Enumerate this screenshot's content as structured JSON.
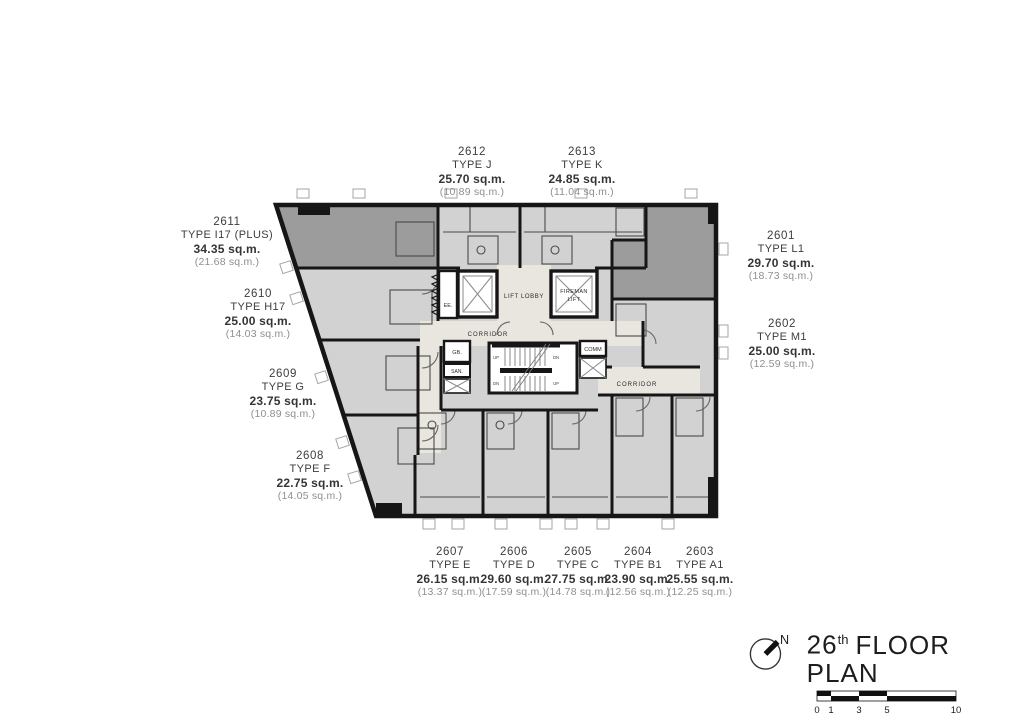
{
  "title": {
    "floor_number": "26",
    "ordinal_suffix": "th",
    "text": "FLOOR PLAN"
  },
  "north": {
    "label": "N"
  },
  "scale_bar": {
    "ticks": [
      "0",
      "1",
      "3",
      "5",
      "10"
    ]
  },
  "core": {
    "lift_lobby": "LIFT LOBBY",
    "fireman_lift_line1": "FIREMAN",
    "fireman_lift_line2": "LIFT",
    "corridor_upper": "CORRIDOR",
    "corridor_lower": "CORRIDOR",
    "ee": "EE.",
    "gb": "GB.",
    "san": "SAN.",
    "comm": "COMM",
    "up": "UP",
    "dn": "DN"
  },
  "units": [
    {
      "number": "2601",
      "type": "TYPE L1",
      "area": "29.70 sq.m.",
      "inner_area": "(18.73 sq.m.)"
    },
    {
      "number": "2602",
      "type": "TYPE M1",
      "area": "25.00 sq.m.",
      "inner_area": "(12.59 sq.m.)"
    },
    {
      "number": "2603",
      "type": "TYPE A1",
      "area": "25.55 sq.m.",
      "inner_area": "(12.25 sq.m.)"
    },
    {
      "number": "2604",
      "type": "TYPE B1",
      "area": "23.90 sq.m.",
      "inner_area": "(12.56 sq.m.)"
    },
    {
      "number": "2605",
      "type": "TYPE C",
      "area": "27.75 sq.m.",
      "inner_area": "(14.78 sq.m.)"
    },
    {
      "number": "2606",
      "type": "TYPE D",
      "area": "29.60 sq.m.",
      "inner_area": "(17.59 sq.m.)"
    },
    {
      "number": "2607",
      "type": "TYPE E",
      "area": "26.15 sq.m.",
      "inner_area": "(13.37 sq.m.)"
    },
    {
      "number": "2608",
      "type": "TYPE F",
      "area": "22.75 sq.m.",
      "inner_area": "(14.05 sq.m.)"
    },
    {
      "number": "2609",
      "type": "TYPE G",
      "area": "23.75 sq.m.",
      "inner_area": "(10.89 sq.m.)"
    },
    {
      "number": "2610",
      "type": "TYPE H17",
      "area": "25.00 sq.m.",
      "inner_area": "(14.03 sq.m.)"
    },
    {
      "number": "2611",
      "type": "TYPE I17 (PLUS)",
      "area": "34.35 sq.m.",
      "inner_area": "(21.68 sq.m.)"
    },
    {
      "number": "2612",
      "type": "TYPE J",
      "area": "25.70 sq.m.",
      "inner_area": "(10.89 sq.m.)"
    },
    {
      "number": "2613",
      "type": "TYPE K",
      "area": "24.85 sq.m.",
      "inner_area": "(11.04 sq.m.)"
    }
  ],
  "colors": {
    "unit_fill": "#d2d2d2",
    "unit_dark_fill": "#9c9c9c",
    "corridor_fill": "#e9e5df",
    "wall": "#161616",
    "label_text": "#3d3d3d",
    "label_muted": "#8f8f8f"
  }
}
